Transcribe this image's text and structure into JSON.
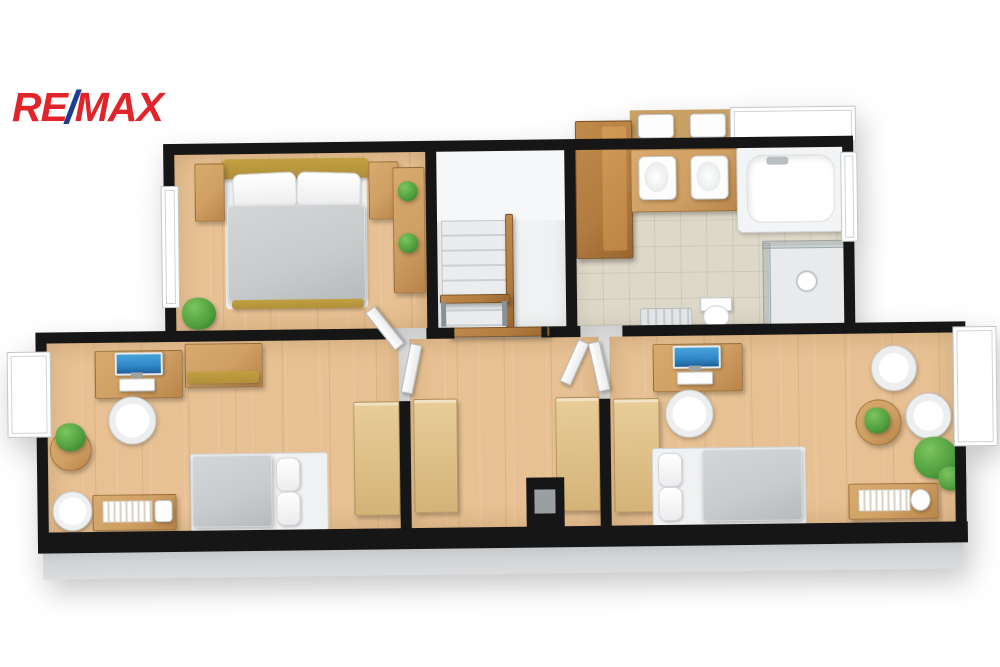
{
  "logo": {
    "re": "RE",
    "slash": "/",
    "max": "MAX"
  },
  "colors": {
    "brand_red": "#e1242a",
    "brand_blue": "#1d3e92",
    "wall": "#161616",
    "wall_side": "#d2d4d6",
    "wood_floor": "#e7c193",
    "tile_floor": "#ded8c8",
    "furn_wood": "#cf9f63",
    "furn_wood_dark": "#b17c3f",
    "olive": "#b1903a",
    "bedding": "#c9cccd",
    "room_white": "#eff1f2",
    "plant": "#4f9d3d",
    "screen": "#2f87c6"
  },
  "floorplan": {
    "view": "3D top-down floor plan, upper storey",
    "rooms": [
      {
        "name": "master-bedroom",
        "floor": "wood",
        "furniture": [
          "double-bed",
          "headboard",
          "nightstand",
          "nightstand",
          "dresser-with-plants",
          "floor-plant",
          "window"
        ]
      },
      {
        "name": "staircase",
        "floor": "white",
        "furniture": [
          "stairs",
          "wooden-handrail",
          "bench",
          "railing"
        ]
      },
      {
        "name": "bathroom",
        "floor": "tile",
        "furniture": [
          "tall-cabinet",
          "double-sink-vanity",
          "mirror",
          "bathtub",
          "dormer-window",
          "shower-enclosure",
          "toilet",
          "radiator",
          "window"
        ]
      },
      {
        "name": "hallway",
        "floor": "wood",
        "furniture": [
          "wardrobe",
          "wardrobe",
          "chimney",
          "open-doors"
        ]
      },
      {
        "name": "bedroom-left",
        "floor": "wood",
        "furniture": [
          "desk",
          "monitor",
          "keyboard",
          "office-chair",
          "wall-cabinet",
          "single-bed",
          "sideboard-with-books",
          "pouf",
          "corner-table-with-plant",
          "wardrobe",
          "dormer-window"
        ]
      },
      {
        "name": "bedroom-right",
        "floor": "wood",
        "furniture": [
          "desk",
          "monitor",
          "keyboard",
          "office-chair",
          "wardrobe",
          "single-bed",
          "sideboard-with-books",
          "armchair",
          "armchair",
          "round-table-with-plant",
          "floor-plant",
          "dormer-window"
        ]
      }
    ]
  }
}
